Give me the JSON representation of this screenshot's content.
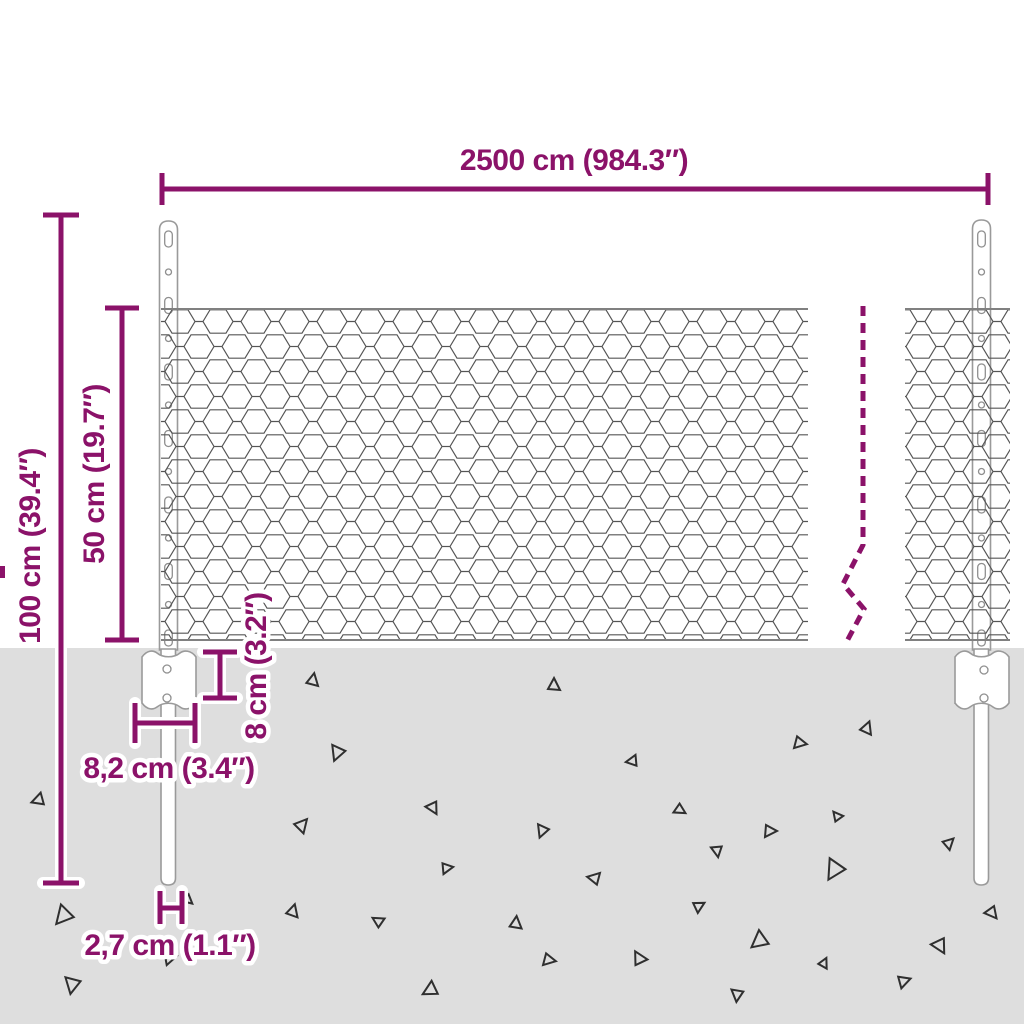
{
  "diagram": {
    "type": "product-dimension-diagram",
    "subject": "wire mesh fence with posts"
  },
  "colors": {
    "accent": "#8B1269",
    "ground": "#DEDEDE",
    "mesh_line": "#555555",
    "post_stroke": "#9A9A9A",
    "triangle": "#2F2F2F"
  },
  "dimensions": {
    "total_width": {
      "label": "2500 cm (984.3″)"
    },
    "total_height": {
      "label": "100 cm (39.4″)"
    },
    "mesh_height": {
      "label": "50 cm (19.7″)"
    },
    "anchor_depth": {
      "label": "8 cm (3.2″)"
    },
    "bracket_width": {
      "label": "8,2 cm (3.4″)"
    },
    "post_width": {
      "label": "2,7 cm (1.1″)"
    }
  },
  "scene": {
    "ground_top": 648,
    "zigzag": [
      [
        863,
        306
      ],
      [
        863,
        545
      ],
      [
        843,
        584
      ],
      [
        864,
        609
      ],
      [
        846,
        643
      ]
    ],
    "triangles": [
      {
        "x": 313,
        "y": 680,
        "s": 1.0,
        "r": 10
      },
      {
        "x": 337,
        "y": 753,
        "s": 1.2,
        "r": 200
      },
      {
        "x": 38,
        "y": 800,
        "s": 1.0,
        "r": 250
      },
      {
        "x": 302,
        "y": 825,
        "s": 1.1,
        "r": 40
      },
      {
        "x": 433,
        "y": 808,
        "s": 1.0,
        "r": 150
      },
      {
        "x": 447,
        "y": 868,
        "s": 0.9,
        "r": 80
      },
      {
        "x": 63,
        "y": 916,
        "s": 1.5,
        "r": 220
      },
      {
        "x": 188,
        "y": 900,
        "s": 0.8,
        "r": 130
      },
      {
        "x": 293,
        "y": 911,
        "s": 1.0,
        "r": 15
      },
      {
        "x": 378,
        "y": 921,
        "s": 0.9,
        "r": 300
      },
      {
        "x": 170,
        "y": 958,
        "s": 1.0,
        "r": 75
      },
      {
        "x": 72,
        "y": 985,
        "s": 1.3,
        "r": 190
      },
      {
        "x": 430,
        "y": 990,
        "s": 1.2,
        "r": 240
      },
      {
        "x": 554,
        "y": 685,
        "s": 1.0,
        "r": 0
      },
      {
        "x": 632,
        "y": 761,
        "s": 0.9,
        "r": 260
      },
      {
        "x": 800,
        "y": 743,
        "s": 1.0,
        "r": 100
      },
      {
        "x": 867,
        "y": 728,
        "s": 1.0,
        "r": 20
      },
      {
        "x": 680,
        "y": 810,
        "s": 0.9,
        "r": 120
      },
      {
        "x": 542,
        "y": 831,
        "s": 1.0,
        "r": 200
      },
      {
        "x": 770,
        "y": 831,
        "s": 1.0,
        "r": 90
      },
      {
        "x": 837,
        "y": 816,
        "s": 0.8,
        "r": 320
      },
      {
        "x": 949,
        "y": 843,
        "s": 0.9,
        "r": 45
      },
      {
        "x": 717,
        "y": 851,
        "s": 0.9,
        "r": 170
      },
      {
        "x": 594,
        "y": 878,
        "s": 1.0,
        "r": 280
      },
      {
        "x": 834,
        "y": 870,
        "s": 1.6,
        "r": 210
      },
      {
        "x": 699,
        "y": 906,
        "s": 0.9,
        "r": 60
      },
      {
        "x": 516,
        "y": 923,
        "s": 1.0,
        "r": 5
      },
      {
        "x": 759,
        "y": 941,
        "s": 1.4,
        "r": 230
      },
      {
        "x": 940,
        "y": 946,
        "s": 1.2,
        "r": 150
      },
      {
        "x": 549,
        "y": 960,
        "s": 1.0,
        "r": 100
      },
      {
        "x": 639,
        "y": 958,
        "s": 1.1,
        "r": 330
      },
      {
        "x": 824,
        "y": 963,
        "s": 0.8,
        "r": 25
      },
      {
        "x": 904,
        "y": 981,
        "s": 1.0,
        "r": 70
      },
      {
        "x": 737,
        "y": 995,
        "s": 1.0,
        "r": 185
      },
      {
        "x": 992,
        "y": 913,
        "s": 1.0,
        "r": 140
      },
      {
        "x": 960,
        "y": 700,
        "s": 0.7,
        "r": 0
      }
    ]
  }
}
